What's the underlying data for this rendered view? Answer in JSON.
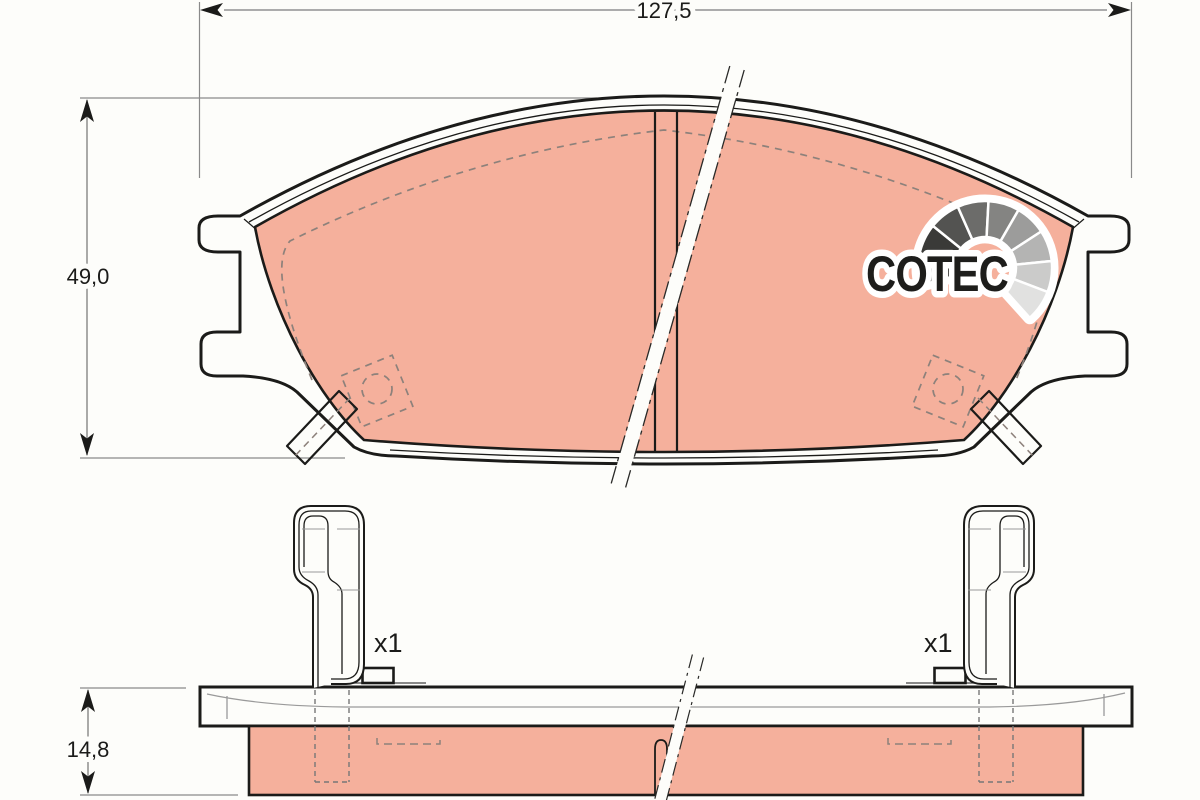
{
  "drawing": {
    "brand_logo": "COTEC",
    "dimensions": {
      "overall_width": "127,5",
      "overall_height": "49,0",
      "overall_thickness": "14,8"
    },
    "annotations": {
      "left_clip_qty": "x1",
      "right_clip_qty": "x1"
    },
    "colors": {
      "background": "#fdfdfa",
      "outline": "#1b1b19",
      "friction_material_fill": "#f5b09c",
      "dimension_line": "#7d7d7d",
      "hidden_line": "#8d817b",
      "logo_fan_palette": [
        "#1d1d1b",
        "#3a3a38",
        "#535351",
        "#6c6c6a",
        "#848482",
        "#9c9c9b",
        "#b4b4b3",
        "#cbcbca",
        "#e1e1e0"
      ]
    }
  }
}
